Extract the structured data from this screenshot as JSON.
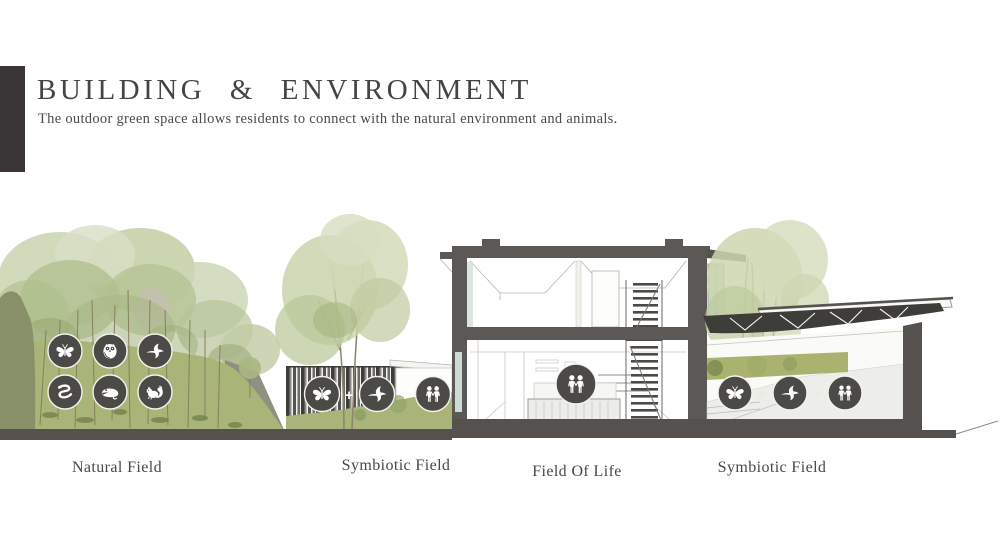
{
  "slide": {
    "title": "BUILDING  &  ENVIRONMENT",
    "subtitle": "The outdoor green space allows residents to connect with the natural environment and animals."
  },
  "fields": {
    "natural": {
      "label": "Natural Field",
      "icons": [
        "butterfly",
        "owl",
        "bird",
        "snake",
        "frog",
        "squirrel"
      ]
    },
    "symbiotic_left": {
      "label": "Symbiotic Field",
      "icons": [
        "butterfly",
        "bird",
        "people"
      ],
      "separator": "+"
    },
    "field_of_life": {
      "label": "Field Of Life",
      "icons": [
        "people"
      ]
    },
    "symbiotic_right": {
      "label": "Symbiotic Field",
      "icons": [
        "butterfly",
        "bird",
        "people"
      ],
      "separator": "+"
    }
  },
  "colors": {
    "accent_dark": "#3a3637",
    "text": "#4b4646",
    "icon_circle": "#4b4a46",
    "wall_dark": "#5b5855",
    "ground": "#55514e",
    "hill_green": "#a9b578",
    "hill_dark": "#879069",
    "tree_light": "#ccd6b4",
    "tree_mid": "#aebd8c",
    "glass": "#c6d8cc"
  }
}
